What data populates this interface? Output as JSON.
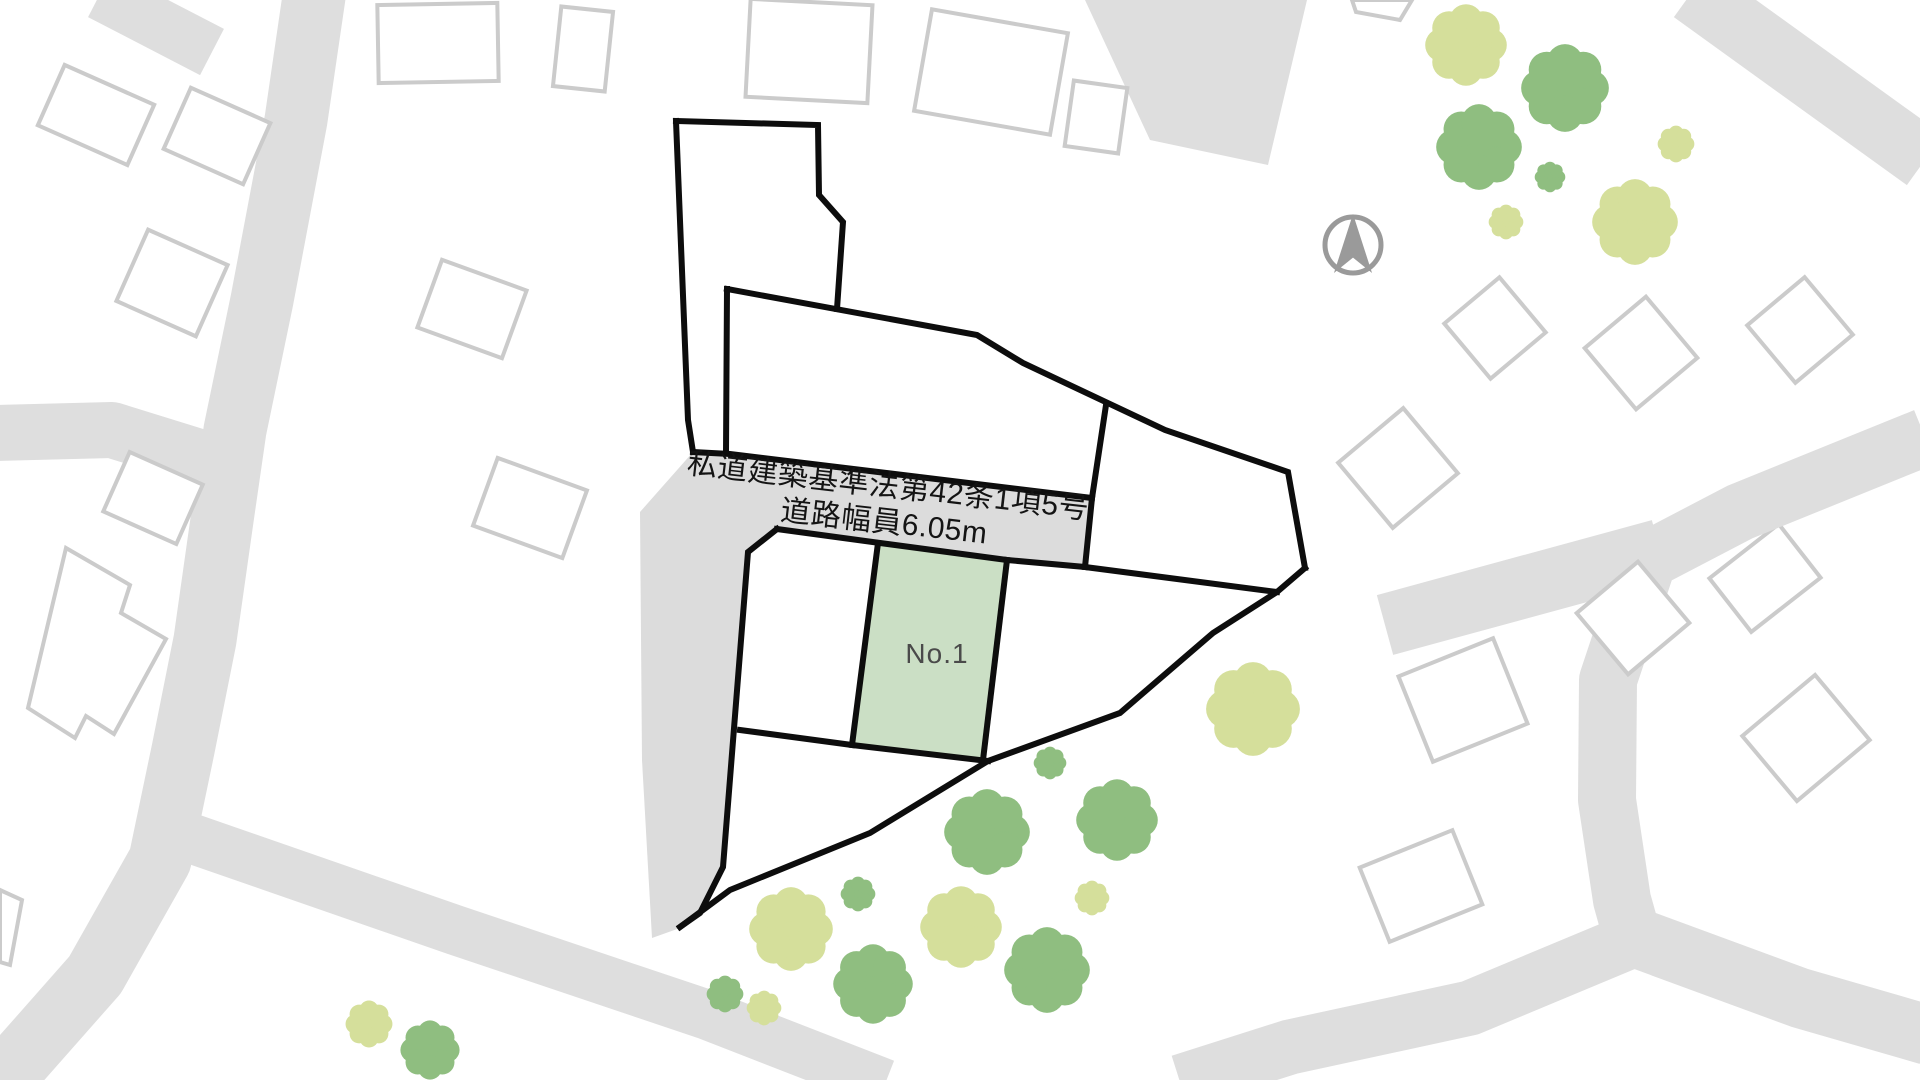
{
  "page": {
    "kind": "real-estate site plan map",
    "width": 1920,
    "height": 1080
  },
  "labels": {
    "private_road": {
      "line1": "私道建築基準法第42条1項5号",
      "line2": "道路幅員6.05m"
    },
    "parcel": "No.1"
  },
  "colors": {
    "background": "#ffffff",
    "road_fill": "#dedede",
    "private_road_fill": "#dcdcdc",
    "building_stroke": "#cbcbcb",
    "building_fill": "#ffffff",
    "boundary": "#0d0d0d",
    "parcel_fill": "#cbdfc5",
    "tree_green": "#8fbe80",
    "tree_light": "#d5df9b",
    "compass": "#9a9a9a"
  },
  "north_arrow": {
    "x": 1353,
    "y": 245,
    "r": 28
  },
  "map": {
    "road_strokes": [
      {
        "d": "M 315,-10 L 296,120 L 262,300 L 235,430 L 222,520 L 205,640 L 183,750 L 160,860 L 95,975 L 20,1060 L -30,1100",
        "w": 63
      },
      {
        "d": "M 100,-6 L 212,52",
        "w": 52
      },
      {
        "d": "M -6,433 L 112,430 L 228,466",
        "w": 56
      },
      {
        "d": "M 190,838 L 455,930 L 705,1014 L 885,1084",
        "w": 50
      },
      {
        "d": "M 1925,437 L 1740,512 L 1648,560 L 1608,680 L 1607,800 L 1622,900 L 1634,943",
        "w": 58
      },
      {
        "d": "M 1615,930 L 1800,998 L 1928,1035",
        "w": 60
      },
      {
        "d": "M 1645,935 L 1470,1008 L 1290,1047 L 1180,1082",
        "w": 55
      },
      {
        "d": "M 1385,625 L 1660,550",
        "w": 62
      },
      {
        "d": "M 1692,-8 L 1925,160",
        "w": 62
      }
    ],
    "road_polys": [
      {
        "name": "private-road-area",
        "pts": "640,512 693,452 730,454 1092,498 1085,567 1007,560 880,543 777,529 748,552 723,867 700,913 680,928 652,938 642,760"
      },
      {
        "name": "gray-block",
        "pts": "1085,0 1150,140 1268,165 1307,0"
      }
    ],
    "buildings_under_roads": [
      {
        "cx": 1765,
        "cy": 578,
        "w": 88,
        "h": 68,
        "rot": -38
      }
    ],
    "buildings": [
      {
        "cx": 96,
        "cy": 115,
        "w": 98,
        "h": 66,
        "rot": 24
      },
      {
        "cx": 217,
        "cy": 136,
        "w": 87,
        "h": 67,
        "rot": 24
      },
      {
        "cx": 172,
        "cy": 283,
        "w": 87,
        "h": 78,
        "rot": 24
      },
      {
        "cx": 153,
        "cy": 498,
        "w": 80,
        "h": 65,
        "rot": 24
      },
      {
        "cx": 438,
        "cy": 43,
        "w": 120,
        "h": 78,
        "rot": -1
      },
      {
        "cx": 472,
        "cy": 309,
        "w": 90,
        "h": 72,
        "rot": 20
      },
      {
        "cx": 530,
        "cy": 508,
        "w": 95,
        "h": 72,
        "rot": 20
      },
      {
        "cx": 583,
        "cy": 49,
        "w": 52,
        "h": 80,
        "rot": 6
      },
      {
        "cx": 809,
        "cy": 51,
        "w": 122,
        "h": 98,
        "rot": 3
      },
      {
        "cx": 991,
        "cy": 72,
        "w": 138,
        "h": 103,
        "rot": 10
      },
      {
        "cx": 1096,
        "cy": 117,
        "w": 54,
        "h": 66,
        "rot": 8
      },
      {
        "cx": 1495,
        "cy": 328,
        "w": 72,
        "h": 72,
        "rot": -40
      },
      {
        "cx": 1641,
        "cy": 353,
        "w": 80,
        "h": 80,
        "rot": -40
      },
      {
        "cx": 1800,
        "cy": 330,
        "w": 75,
        "h": 75,
        "rot": -40
      },
      {
        "cx": 1398,
        "cy": 468,
        "w": 85,
        "h": 85,
        "rot": -40
      },
      {
        "cx": 1463,
        "cy": 700,
        "w": 102,
        "h": 92,
        "rot": -22
      },
      {
        "cx": 1633,
        "cy": 618,
        "w": 80,
        "h": 80,
        "rot": -40
      },
      {
        "cx": 1806,
        "cy": 738,
        "w": 95,
        "h": 85,
        "rot": -40
      },
      {
        "cx": 1421,
        "cy": 886,
        "w": 100,
        "h": 80,
        "rot": -22
      }
    ],
    "building_polys": [
      {
        "pts": "66,548 130,585 121,613 166,639 114,734 86,716 75,738 28,708"
      },
      {
        "pts": "0,890 22,900 10,965 0,962"
      },
      {
        "pts": "1352,0 1412,0 1400,20 1356,12"
      }
    ],
    "parcel_no1": {
      "pts": "878,543 1007,560 983,760 852,745"
    },
    "boundary_lines": [
      "M 676,121 L 818,125 L 819,195 L 843,222 L 837,309",
      "M 676,121 L 688,420 L 693,452",
      "M 727,289 L 726,453",
      "M 727,289 L 977,335 L 1023,363 L 1165,430 L 1288,472 L 1305,568",
      "M 1305,568 L 1277,592 L 1213,633 L 1120,713 L 988,761 L 870,833 L 730,890 L 680,927",
      "M 777,529 L 748,552 L 723,867 L 700,913 L 680,927",
      "M 693,452 L 730,454 L 1092,498",
      "M 1106,405 L 1092,498 L 1085,567",
      "M 777,529 L 880,543 L 1007,560 L 1085,567",
      "M 1085,567 L 1277,592",
      "M 878,543 L 852,745",
      "M 1007,560 L 983,760",
      "M 740,730 L 852,745 L 988,761"
    ],
    "trees": [
      {
        "v": "light",
        "x": 1466,
        "y": 45,
        "r": 40
      },
      {
        "v": "green",
        "x": 1565,
        "y": 88,
        "r": 43
      },
      {
        "v": "green",
        "x": 1479,
        "y": 147,
        "r": 42
      },
      {
        "v": "green",
        "x": 1550,
        "y": 177,
        "r": 15
      },
      {
        "v": "light",
        "x": 1676,
        "y": 144,
        "r": 18
      },
      {
        "v": "light",
        "x": 1506,
        "y": 222,
        "r": 17
      },
      {
        "v": "light",
        "x": 1635,
        "y": 222,
        "r": 42
      },
      {
        "v": "light",
        "x": 1253,
        "y": 709,
        "r": 46
      },
      {
        "v": "green",
        "x": 1050,
        "y": 763,
        "r": 16
      },
      {
        "v": "green",
        "x": 987,
        "y": 832,
        "r": 42
      },
      {
        "v": "green",
        "x": 1117,
        "y": 820,
        "r": 40
      },
      {
        "v": "light",
        "x": 1092,
        "y": 898,
        "r": 17
      },
      {
        "v": "green",
        "x": 858,
        "y": 894,
        "r": 17
      },
      {
        "v": "light",
        "x": 791,
        "y": 929,
        "r": 41
      },
      {
        "v": "light",
        "x": 961,
        "y": 927,
        "r": 40
      },
      {
        "v": "green",
        "x": 1047,
        "y": 970,
        "r": 42
      },
      {
        "v": "green",
        "x": 873,
        "y": 984,
        "r": 39
      },
      {
        "v": "green",
        "x": 725,
        "y": 994,
        "r": 18
      },
      {
        "v": "light",
        "x": 764,
        "y": 1008,
        "r": 17
      },
      {
        "v": "light",
        "x": 369,
        "y": 1024,
        "r": 23
      },
      {
        "v": "green",
        "x": 430,
        "y": 1050,
        "r": 29
      }
    ]
  }
}
